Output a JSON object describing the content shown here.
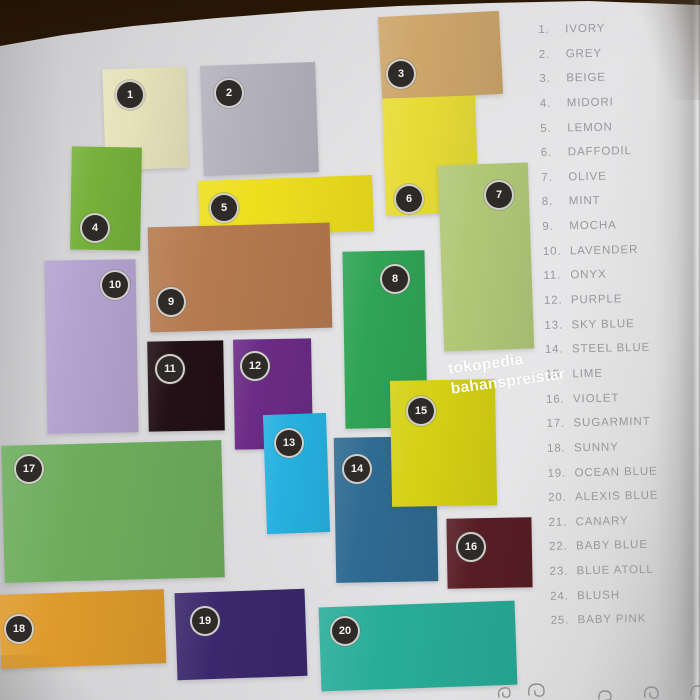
{
  "photo": {
    "watermark": {
      "line1": "tokopedia",
      "line2": "bahanspreistar"
    },
    "wood_color": "#3a2209",
    "page_color": "#e2e2e4",
    "legend_text_color": "#98979a",
    "badge_color": "#2e2a27"
  },
  "legend": {
    "items": [
      {
        "number": "1.",
        "name": "IVORY"
      },
      {
        "number": "2.",
        "name": "GREY"
      },
      {
        "number": "3.",
        "name": "BEIGE"
      },
      {
        "number": "4.",
        "name": "MIDORI"
      },
      {
        "number": "5.",
        "name": "LEMON"
      },
      {
        "number": "6.",
        "name": "DAFFODIL"
      },
      {
        "number": "7.",
        "name": "OLIVE"
      },
      {
        "number": "8.",
        "name": "MINT"
      },
      {
        "number": "9.",
        "name": "MOCHA"
      },
      {
        "number": "10.",
        "name": "LAVENDER"
      },
      {
        "number": "11.",
        "name": "ONYX"
      },
      {
        "number": "12.",
        "name": "PURPLE"
      },
      {
        "number": "13.",
        "name": "SKY BLUE"
      },
      {
        "number": "14.",
        "name": "STEEL BLUE"
      },
      {
        "number": "15.",
        "name": "LIME"
      },
      {
        "number": "16.",
        "name": "VIOLET"
      },
      {
        "number": "17.",
        "name": "SUGARMINT"
      },
      {
        "number": "18.",
        "name": "SUNNY"
      },
      {
        "number": "19.",
        "name": "OCEAN BLUE"
      },
      {
        "number": "20.",
        "name": "ALEXIS BLUE"
      },
      {
        "number": "21.",
        "name": "CANARY"
      },
      {
        "number": "22.",
        "name": "BABY BLUE"
      },
      {
        "number": "23.",
        "name": "BLUE ATOLL"
      },
      {
        "number": "24.",
        "name": "BLUSH"
      },
      {
        "number": "25.",
        "name": "BABY PINK"
      }
    ]
  },
  "swatches": [
    {
      "number": "1",
      "name": "IVORY",
      "color": "#e6e2ba",
      "x": 104,
      "y": 68,
      "w": 83,
      "h": 101,
      "rotate": -2,
      "bx": 128,
      "by": 93
    },
    {
      "number": "2",
      "name": "GREY",
      "color": "#b4b2bd",
      "x": 202,
      "y": 64,
      "w": 115,
      "h": 110,
      "rotate": -2,
      "bx": 227,
      "by": 91
    },
    {
      "number": "3",
      "name": "BEIGE",
      "color": "#cda66b",
      "x": 380,
      "y": 14,
      "w": 121,
      "h": 83,
      "rotate": -3,
      "bx": 399,
      "by": 72
    },
    {
      "number": "4",
      "name": "MIDORI",
      "color": "#76b13b",
      "x": 71,
      "y": 147,
      "w": 70,
      "h": 103,
      "rotate": 1,
      "bx": 93,
      "by": 226
    },
    {
      "number": "5",
      "name": "LEMON",
      "color": "#eedf1e",
      "x": 199,
      "y": 178,
      "w": 174,
      "h": 56,
      "rotate": -2,
      "bx": 222,
      "by": 206
    },
    {
      "number": "6",
      "name": "DAFFODIL",
      "color": "#e7dc36",
      "x": 384,
      "y": 97,
      "w": 93,
      "h": 117,
      "rotate": -2,
      "bx": 407,
      "by": 197
    },
    {
      "number": "7",
      "name": "OLIVE",
      "color": "#b1c878",
      "x": 441,
      "y": 164,
      "w": 90,
      "h": 186,
      "rotate": -2,
      "bx": 497,
      "by": 193
    },
    {
      "number": "8",
      "name": "MINT",
      "color": "#30a455",
      "x": 344,
      "y": 251,
      "w": 82,
      "h": 177,
      "rotate": -1,
      "bx": 393,
      "by": 277
    },
    {
      "number": "9",
      "name": "MOCHA",
      "color": "#b57a4f",
      "x": 149,
      "y": 225,
      "w": 182,
      "h": 105,
      "rotate": -1.5,
      "bx": 169,
      "by": 300
    },
    {
      "number": "10",
      "name": "LAVENDER",
      "color": "#b4a3d0",
      "x": 46,
      "y": 260,
      "w": 91,
      "h": 173,
      "rotate": -1,
      "bx": 113,
      "by": 283
    },
    {
      "number": "11",
      "name": "ONYX",
      "color": "#221116",
      "x": 148,
      "y": 341,
      "w": 76,
      "h": 90,
      "rotate": -1,
      "bx": 168,
      "by": 367
    },
    {
      "number": "12",
      "name": "PURPLE",
      "color": "#6b2b86",
      "x": 234,
      "y": 339,
      "w": 78,
      "h": 110,
      "rotate": -1,
      "bx": 253,
      "by": 364
    },
    {
      "number": "13",
      "name": "SKY BLUE",
      "color": "#27b1e0",
      "x": 265,
      "y": 414,
      "w": 63,
      "h": 119,
      "rotate": -2,
      "bx": 287,
      "by": 441
    },
    {
      "number": "14",
      "name": "STEEL BLUE",
      "color": "#2f6b92",
      "x": 335,
      "y": 437,
      "w": 102,
      "h": 145,
      "rotate": -1,
      "bx": 355,
      "by": 467
    },
    {
      "number": "15",
      "name": "LIME",
      "color": "#d5d115",
      "x": 391,
      "y": 380,
      "w": 105,
      "h": 126,
      "rotate": -1,
      "bx": 419,
      "by": 409
    },
    {
      "number": "16",
      "name": "VIOLET",
      "color": "#581d24",
      "x": 447,
      "y": 518,
      "w": 85,
      "h": 70,
      "rotate": -1,
      "bx": 469,
      "by": 545
    },
    {
      "number": "17",
      "name": "SUGARMINT",
      "color": "#6ead5d",
      "x": 3,
      "y": 443,
      "w": 220,
      "h": 137,
      "rotate": -1.5,
      "bx": 27,
      "by": 467
    },
    {
      "number": "18",
      "name": "SUNNY",
      "color": "#de9b2c",
      "x": 0,
      "y": 592,
      "w": 165,
      "h": 74,
      "rotate": -2,
      "bx": 17,
      "by": 627
    },
    {
      "number": "19",
      "name": "OCEAN BLUE",
      "color": "#3a286c",
      "x": 176,
      "y": 591,
      "w": 130,
      "h": 87,
      "rotate": -2,
      "bx": 203,
      "by": 619
    },
    {
      "number": "20",
      "name": "ALEXIS BLUE",
      "color": "#28ad99",
      "x": 320,
      "y": 604,
      "w": 196,
      "h": 84,
      "rotate": -2,
      "bx": 343,
      "by": 629
    }
  ]
}
